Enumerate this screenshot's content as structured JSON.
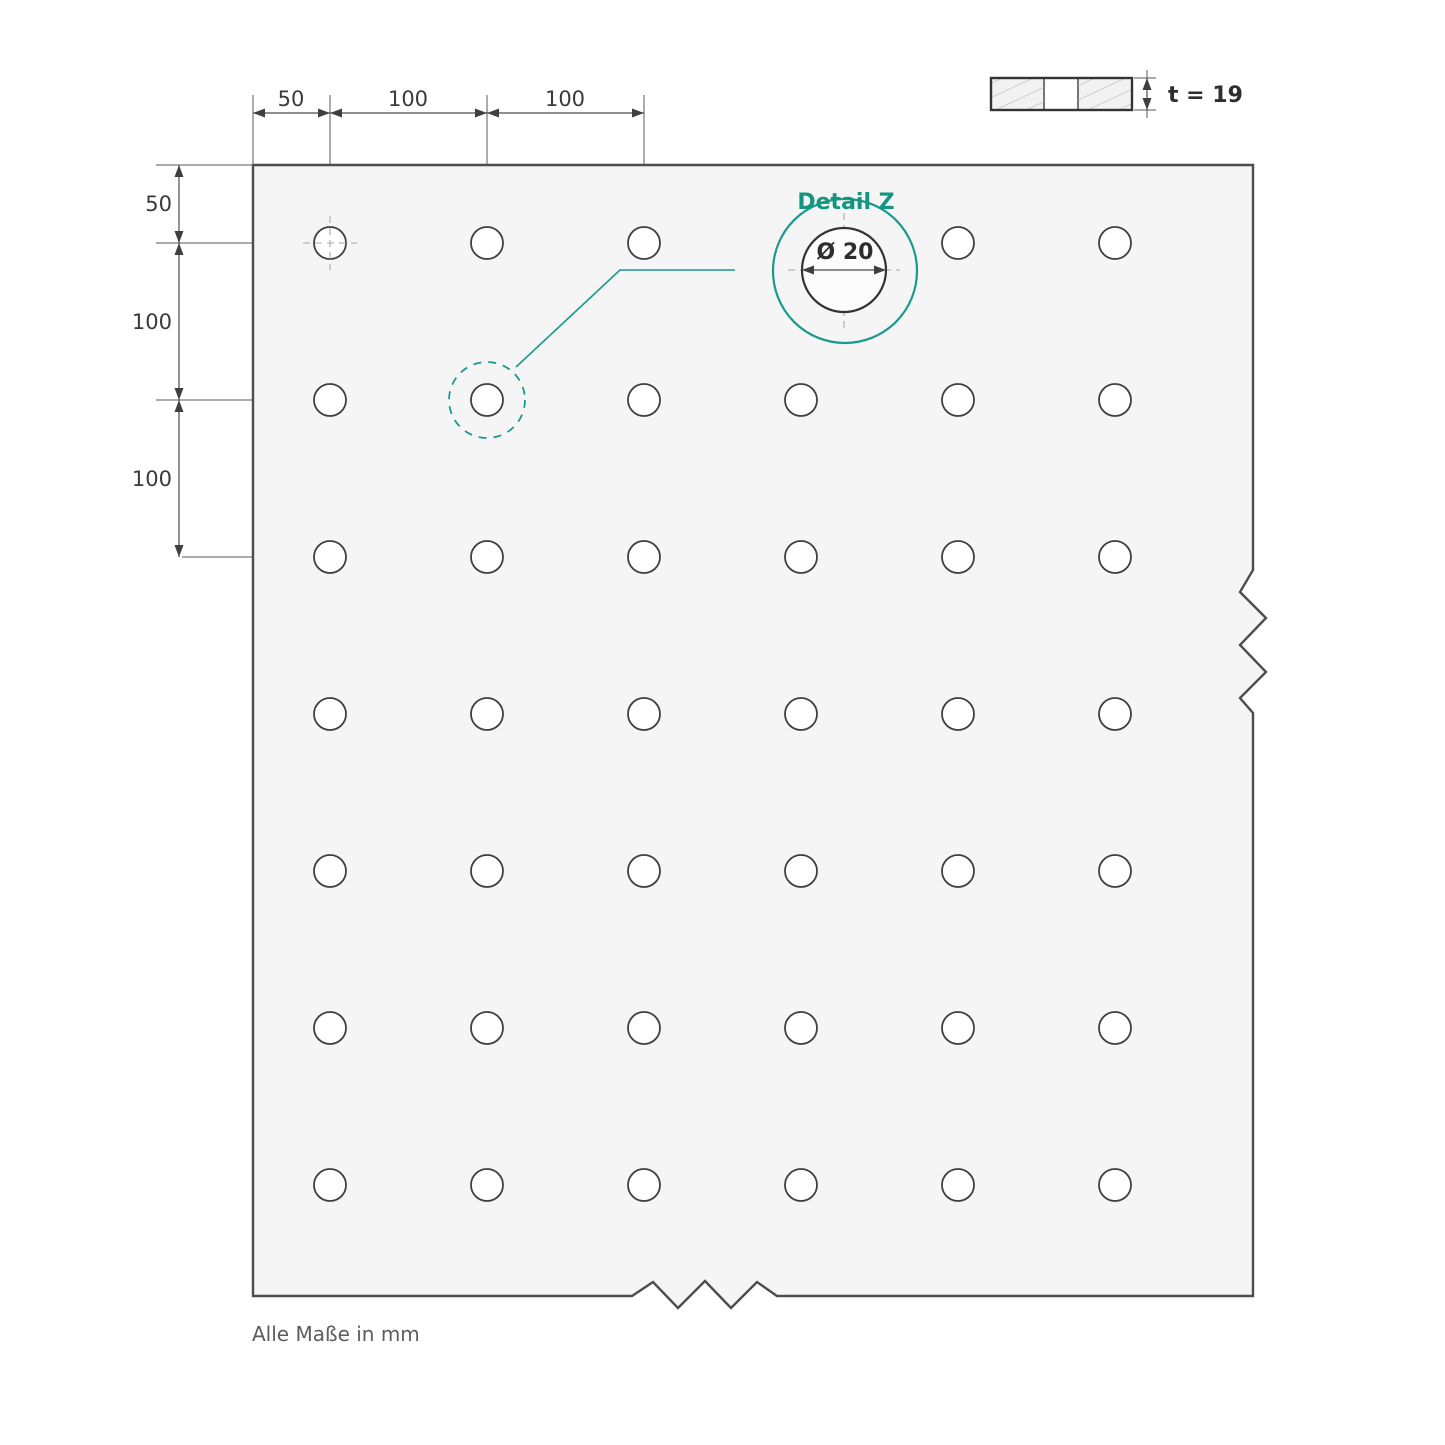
{
  "note": {
    "text": "Alle Maße in mm"
  },
  "dimensions": {
    "top": [
      {
        "label": "50"
      },
      {
        "label": "100"
      },
      {
        "label": "100"
      }
    ],
    "left": [
      {
        "label": "50"
      },
      {
        "label": "100"
      },
      {
        "label": "100"
      }
    ]
  },
  "detail": {
    "title": "Detail Z",
    "diameter": "Ø 20"
  },
  "section": {
    "thickness": "t = 19"
  },
  "plate": {
    "grid": {
      "rows": 7,
      "cols": 6,
      "col_start": 330,
      "row_start": 243,
      "spacing": 157,
      "hole_radius": 16,
      "hidden": [
        {
          "row": 0,
          "col": 3
        }
      ]
    }
  },
  "colors": {
    "accent_teal": "#1a9a8b",
    "plate_fill": "#f5f5f6",
    "outline": "#4d4d4d",
    "hole_stroke": "#3f3f3f",
    "dim_text": "#3a3a3a",
    "note_text": "#5d5d5d",
    "hatch": "#b8b8b8"
  }
}
